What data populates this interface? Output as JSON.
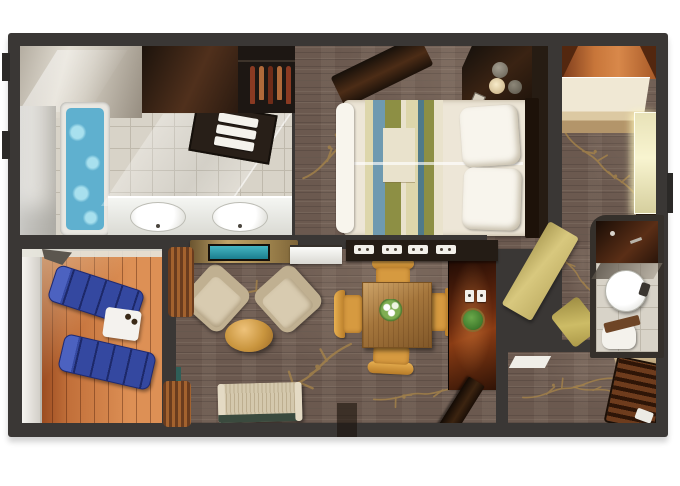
{
  "title": "Suite floor plan (top-down 3D rendering, no text labels)",
  "palette": {
    "wall": "#3a3735",
    "wallDark": "#2b2927",
    "tile": "#d8d3c8",
    "tileLine": "#bfb9ac",
    "carpet": "#6b594f",
    "branch": "#a5834a",
    "deck": "#c2703a",
    "deckDark": "#96471d",
    "deckLight": "#dd9055",
    "water": "#5fb0cf",
    "waterLight": "#a8e0ee",
    "tub": "#e9e7e1",
    "duvet": "#ede6d7",
    "pillow": "#f8f5ed",
    "stripeBlue": "#6f9ab0",
    "stripeOlive": "#8d8f44",
    "stripeCream": "#ddd6ab",
    "stripeTeal": "#4f7a8a",
    "lounger": "#3448a0",
    "armchair": "#d8cbb0",
    "armchairDark": "#c0b091",
    "sofa": "#d4c8ad",
    "coffeeWood": "#c9953e",
    "tableWood": "#a5763c",
    "chairGold": "#d69a40",
    "chairGoldDark": "#b87c28",
    "tvCabinet": "#ab8f55",
    "tvScreen": "#1b7e8e",
    "cherry": "#8a3c14",
    "doorGold": "#d8c87e",
    "teal": "#2f5f58",
    "white": "#f4f2ec",
    "clothes1": "#8a3a22",
    "clothes2": "#b06a3a",
    "clothes3": "#702c18"
  },
  "rooms": [
    {
      "name": "master-bathroom",
      "items": [
        "shower",
        "water-closet",
        "jetted-tub",
        "double-sink-vanity",
        "towel-shelf",
        "glass-partition"
      ]
    },
    {
      "name": "walk-in-closet",
      "items": [
        "hanging-clothes",
        "shelving"
      ]
    },
    {
      "name": "master-bedroom",
      "items": [
        "bed-with-striped-runner",
        "two-pillows",
        "corner-vanity",
        "stools",
        "lamp"
      ]
    },
    {
      "name": "second-room",
      "items": [
        "wardrobe-counter",
        "mirror-panel",
        "orange-ceiling-strip"
      ]
    },
    {
      "name": "second-bathroom",
      "items": [
        "shower",
        "round-sink",
        "toilet",
        "gold-open-door"
      ]
    },
    {
      "name": "living-area",
      "items": [
        "tv-cabinet",
        "bar-counter",
        "two-armchairs",
        "round-coffee-table",
        "sofa",
        "curtains"
      ]
    },
    {
      "name": "dining-area",
      "items": [
        "square-dining-table",
        "four-gold-chairs",
        "flower-centerpiece",
        "sideboard-with-trays",
        "cherry-cabinet",
        "light-switches",
        "plant",
        "entry-door"
      ]
    },
    {
      "name": "entry-hall",
      "items": [
        "door-mat",
        "shelf",
        "slatted-bench",
        "pillow"
      ]
    },
    {
      "name": "balcony",
      "items": [
        "two-blue-loungers",
        "white-side-table",
        "cups",
        "railing",
        "folded-chair"
      ]
    }
  ]
}
